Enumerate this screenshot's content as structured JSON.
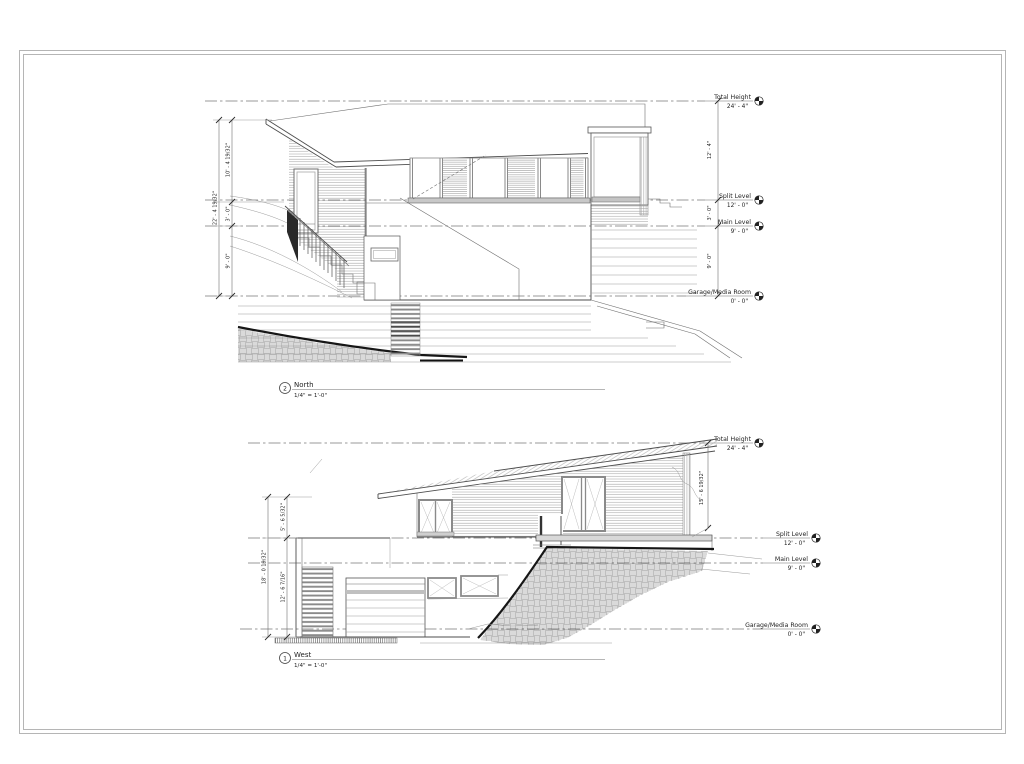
{
  "sheet": {
    "background": "#ffffff",
    "frame_color": "#b5b5b5",
    "line_color": "#4d4d4d"
  },
  "levels": [
    {
      "name": "Total Height",
      "elevation": "24' - 4\""
    },
    {
      "name": "Split Level",
      "elevation": "12' - 0\""
    },
    {
      "name": "Main Level",
      "elevation": "9' - 0\""
    },
    {
      "name": "Garage/Media Room",
      "elevation": "0' - 0\""
    }
  ],
  "views": {
    "north": {
      "number": "2",
      "name": "North",
      "scale": "1/4\" = 1'-0\"",
      "dims_left": [
        "10' - 4 19/32\"",
        "3' - 0\"",
        "9' - 0\"",
        "22' - 4 19/32\""
      ],
      "dims_right": [
        "12' - 4\"",
        "3' - 0\"",
        "9' - 0\""
      ]
    },
    "west": {
      "number": "1",
      "name": "West",
      "scale": "1/4\" = 1'-0\"",
      "dims_left": [
        "5' - 6 5/32\"",
        "12' - 6 7/16\"",
        "18' - 0 19/32\""
      ],
      "dims_right": [
        "15' - 6 19/32\""
      ]
    }
  }
}
